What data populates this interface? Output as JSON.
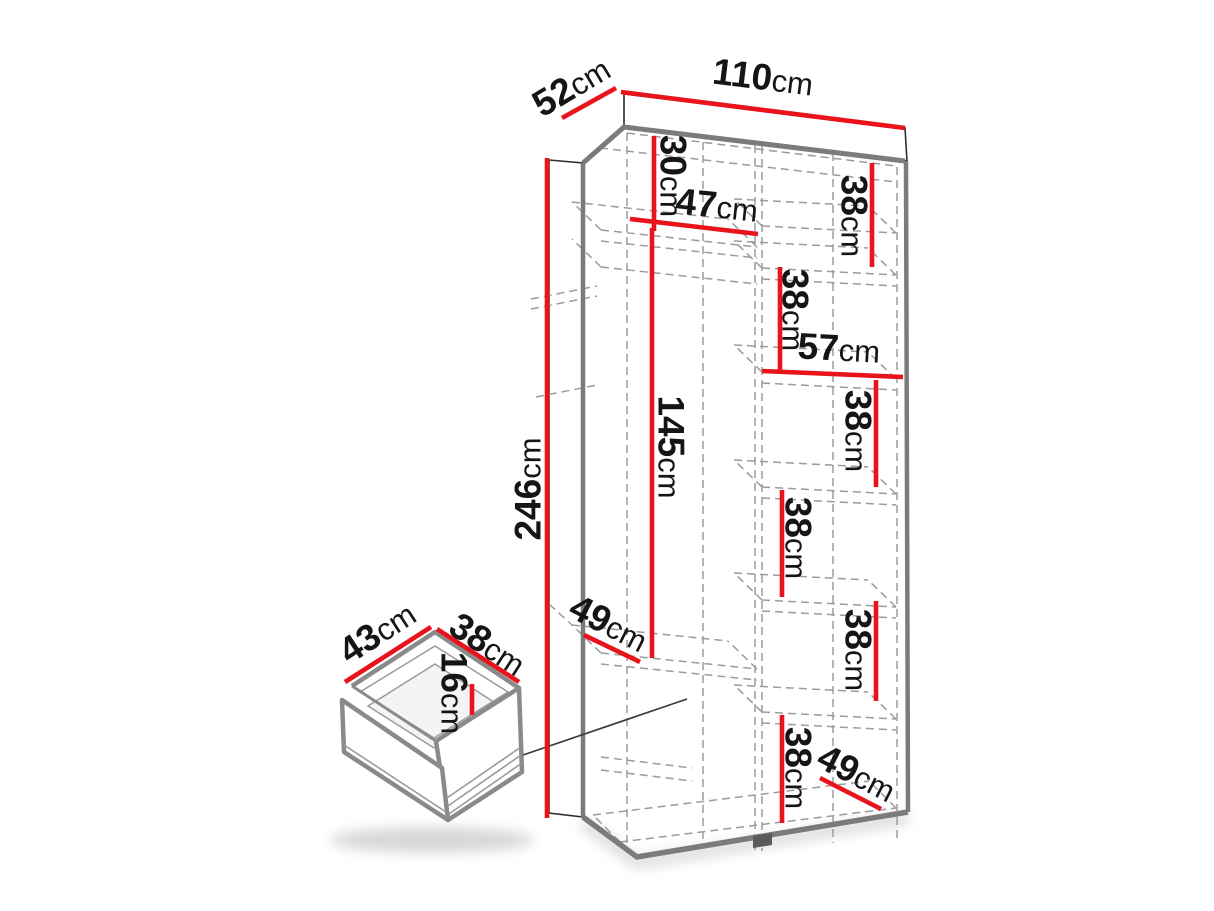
{
  "diagram": {
    "kind": "wardrobe dimension drawing",
    "unit": "cm"
  },
  "colors": {
    "dimension_line": "#e8131b",
    "outline_gray": "#7b7b7b",
    "dashed_gray": "#9b9b9b",
    "text": "#151515"
  },
  "dims": {
    "width": {
      "value": "110",
      "unit": "cm"
    },
    "depth": {
      "value": "52",
      "unit": "cm"
    },
    "height": {
      "value": "246",
      "unit": "cm"
    },
    "top_shelf_drop": {
      "value": "30",
      "unit": "cm"
    },
    "left_section_width": {
      "value": "47",
      "unit": "cm"
    },
    "hanging_space_height": {
      "value": "145",
      "unit": "cm"
    },
    "right_section_width": {
      "value": "57",
      "unit": "cm"
    },
    "shelf_gaps": [
      {
        "value": "38",
        "unit": "cm"
      },
      {
        "value": "38",
        "unit": "cm"
      },
      {
        "value": "38",
        "unit": "cm"
      },
      {
        "value": "38",
        "unit": "cm"
      },
      {
        "value": "38",
        "unit": "cm"
      },
      {
        "value": "38",
        "unit": "cm"
      }
    ],
    "left_shelf_depth": {
      "value": "49",
      "unit": "cm"
    },
    "right_shelf_depth": {
      "value": "49",
      "unit": "cm"
    }
  },
  "drawer": {
    "side_a": {
      "value": "43",
      "unit": "cm"
    },
    "side_b": {
      "value": "38",
      "unit": "cm"
    },
    "height": {
      "value": "16",
      "unit": "cm"
    }
  }
}
